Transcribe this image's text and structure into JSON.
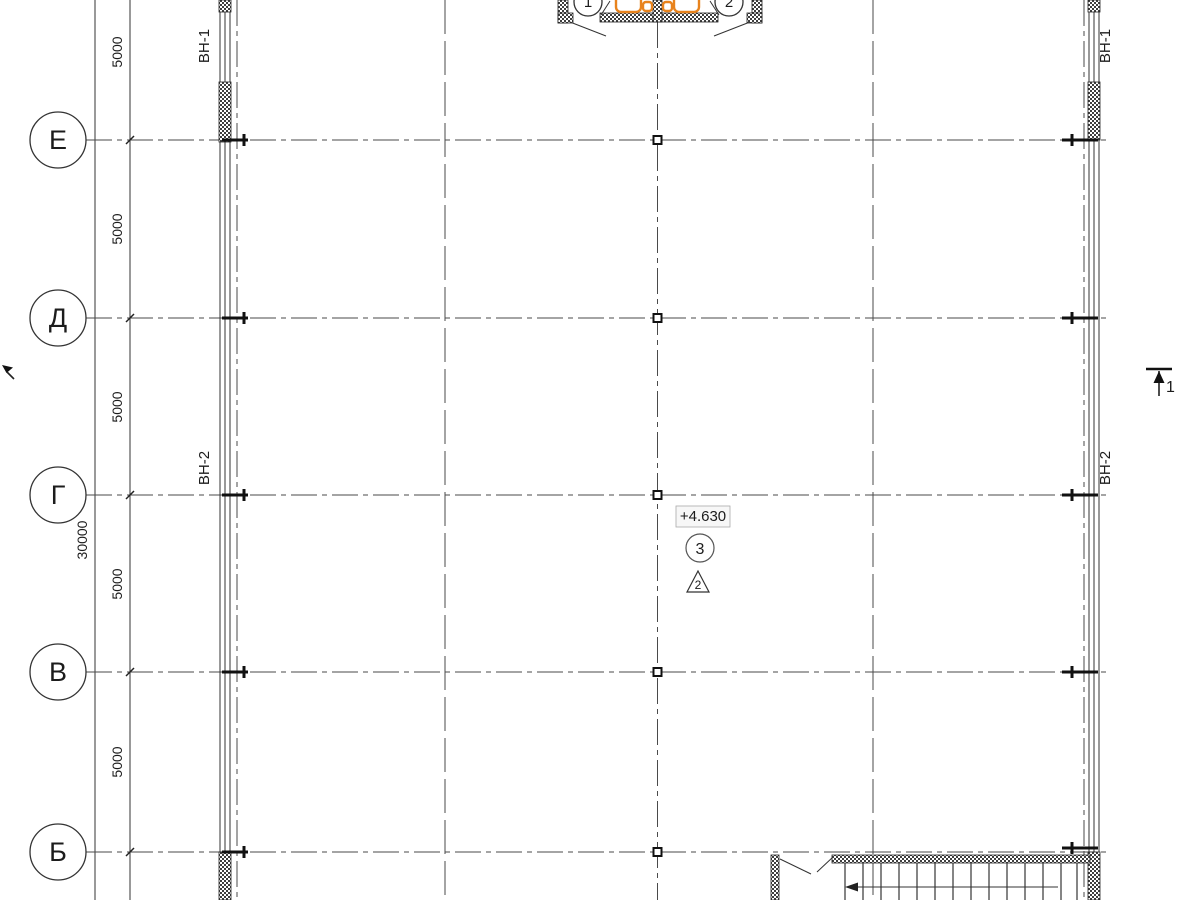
{
  "plan": {
    "axis_rows": [
      {
        "label": "Е"
      },
      {
        "label": "Д"
      },
      {
        "label": "Г"
      },
      {
        "label": "В"
      },
      {
        "label": "Б"
      }
    ],
    "axis_cols": [
      {
        "label": "1"
      },
      {
        "label": "2"
      }
    ],
    "dims": {
      "bays": [
        "5000",
        "5000",
        "5000",
        "5000",
        "5000"
      ],
      "total": "30000"
    },
    "windows": {
      "top_left": "ВН-1",
      "top_right": "ВН-1",
      "mid_left": "ВН-2",
      "mid_right": "ВН-2"
    },
    "elevation": "+4.630",
    "detail_circle": "3",
    "node_triangle": "2",
    "section_label": "1",
    "colors": {
      "accent_orange": "#e8831d",
      "line": "#3a3a3a"
    }
  }
}
